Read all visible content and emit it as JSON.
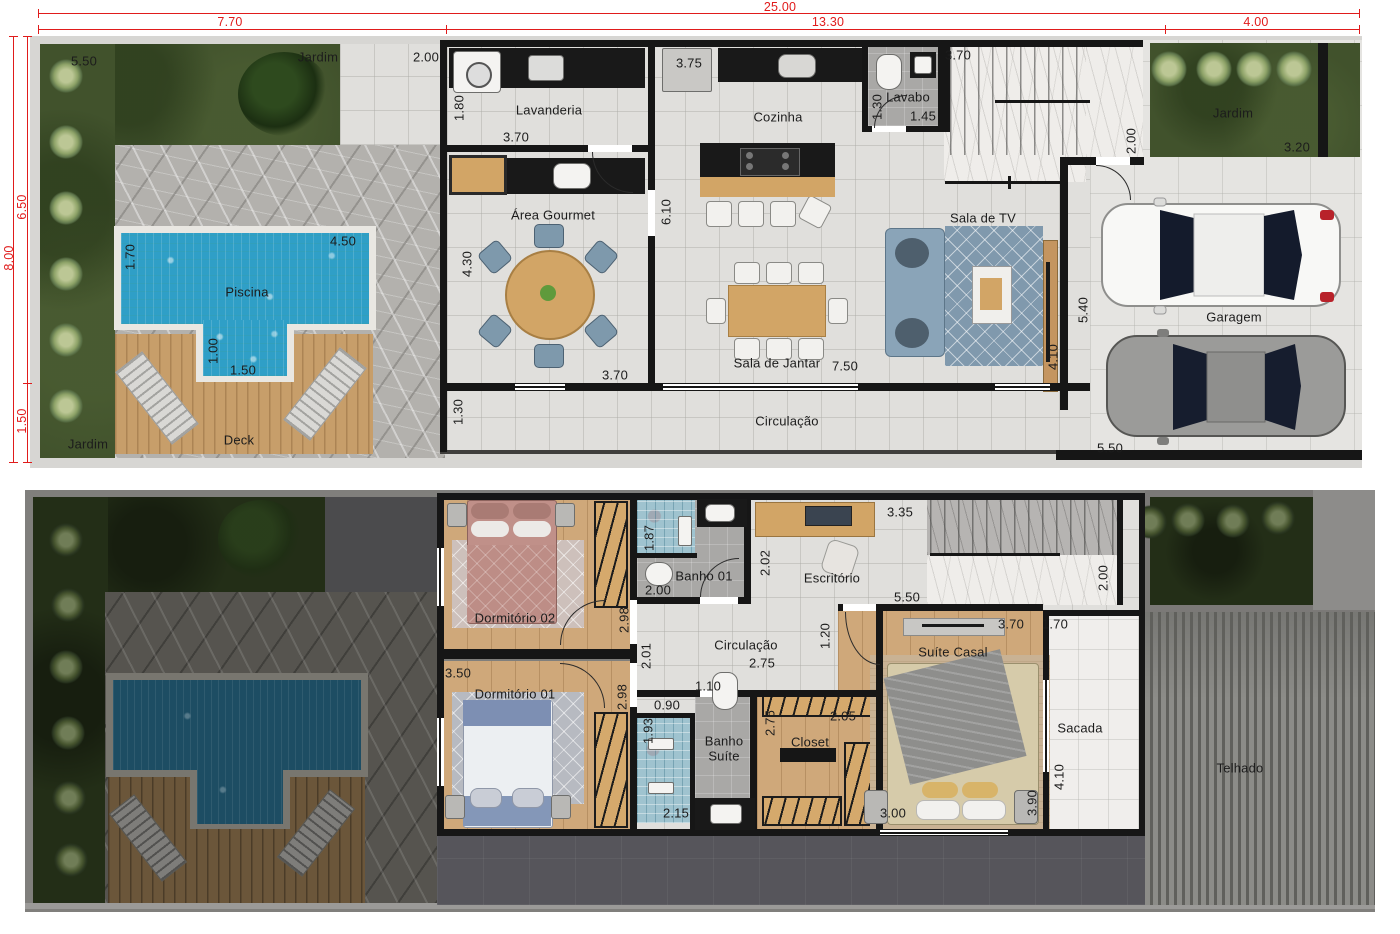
{
  "site_dimensions": {
    "total_width": "25.00",
    "width_segments": [
      "7.70",
      "13.30",
      "4.00"
    ],
    "total_depth": "8.00",
    "depth_segments": [
      "6.50",
      "1.50"
    ],
    "labels": [
      {
        "text": "25.00",
        "x": 780,
        "y": 7
      },
      {
        "text": "7.70",
        "x": 230,
        "y": 22
      },
      {
        "text": "13.30",
        "x": 828,
        "y": 22
      },
      {
        "text": "4.00",
        "x": 1256,
        "y": 22
      },
      {
        "text": "8.00",
        "x": 9,
        "y": 258,
        "v": true
      },
      {
        "text": "6.50",
        "x": 22,
        "y": 207,
        "v": true
      },
      {
        "text": "1.50",
        "x": 22,
        "y": 421,
        "v": true
      }
    ]
  },
  "colors": {
    "dimension_red": "#e01b1b",
    "wall_black": "#161616",
    "pool_blue": "#2f9fc7",
    "deck_wood": "#c79e6a",
    "garden_green": "#41522c",
    "upper_wood_floor": "#cfa87a"
  },
  "ground_floor": {
    "rooms": [
      "Jardim",
      "Piscina",
      "Deck",
      "Lavanderia",
      "Área Gourmet",
      "Cozinha",
      "Lavabo",
      "Sala de TV",
      "Sala de Jantar",
      "Circulação",
      "Garagem"
    ],
    "labels": [
      {
        "text": "5.50",
        "x": 84,
        "y": 61
      },
      {
        "text": "Jardim",
        "x": 318,
        "y": 57
      },
      {
        "text": "2.00",
        "x": 426,
        "y": 57
      },
      {
        "text": "1.80",
        "x": 459,
        "y": 108,
        "v": true
      },
      {
        "text": "Lavanderia",
        "x": 549,
        "y": 110
      },
      {
        "text": "3.70",
        "x": 516,
        "y": 137
      },
      {
        "text": "3.75",
        "x": 689,
        "y": 63
      },
      {
        "text": "Cozinha",
        "x": 778,
        "y": 117
      },
      {
        "text": "1.30",
        "x": 877,
        "y": 107,
        "v": true
      },
      {
        "text": "Lavabo",
        "x": 908,
        "y": 97
      },
      {
        "text": "1.45",
        "x": 923,
        "y": 116
      },
      {
        "text": "3.70",
        "x": 958,
        "y": 55
      },
      {
        "text": "2.00",
        "x": 1131,
        "y": 141,
        "v": true
      },
      {
        "text": "Jardim",
        "x": 1233,
        "y": 113
      },
      {
        "text": "3.20",
        "x": 1297,
        "y": 147
      },
      {
        "text": "Área Gourmet",
        "x": 553,
        "y": 215
      },
      {
        "text": "4.30",
        "x": 467,
        "y": 264,
        "v": true
      },
      {
        "text": "6.10",
        "x": 666,
        "y": 212,
        "v": true
      },
      {
        "text": "Sala de TV",
        "x": 983,
        "y": 218
      },
      {
        "text": "1.70",
        "x": 130,
        "y": 257,
        "v": true
      },
      {
        "text": "4.50",
        "x": 343,
        "y": 241
      },
      {
        "text": "Piscina",
        "x": 247,
        "y": 292
      },
      {
        "text": "1.00",
        "x": 213,
        "y": 351,
        "v": true
      },
      {
        "text": "1.50",
        "x": 243,
        "y": 370
      },
      {
        "text": "Sala de Jantar",
        "x": 777,
        "y": 363
      },
      {
        "text": "7.50",
        "x": 845,
        "y": 366
      },
      {
        "text": "5.40",
        "x": 1083,
        "y": 310,
        "v": true
      },
      {
        "text": "4.10",
        "x": 1053,
        "y": 357,
        "v": true
      },
      {
        "text": "Garagem",
        "x": 1234,
        "y": 317
      },
      {
        "text": "Deck",
        "x": 239,
        "y": 440
      },
      {
        "text": "Jardim",
        "x": 88,
        "y": 444
      },
      {
        "text": "1.30",
        "x": 458,
        "y": 412,
        "v": true
      },
      {
        "text": "Circulação",
        "x": 787,
        "y": 421
      },
      {
        "text": "3.70",
        "x": 615,
        "y": 375
      },
      {
        "text": "5.50",
        "x": 1110,
        "y": 448
      }
    ]
  },
  "upper_floor": {
    "rooms": [
      "Dormitório 02",
      "Banho 01",
      "Escritório",
      "Circulação",
      "Dormitório 01",
      "Banho Suíte",
      "Closet",
      "Suíte Casal",
      "Sacada",
      "Telhado"
    ],
    "labels": [
      {
        "text": "1.87",
        "x": 649,
        "y": 538,
        "v": true
      },
      {
        "text": "Banho 01",
        "x": 704,
        "y": 576
      },
      {
        "text": "2.00",
        "x": 658,
        "y": 590
      },
      {
        "text": "2.02",
        "x": 765,
        "y": 563,
        "v": true
      },
      {
        "text": "Escritório",
        "x": 832,
        "y": 578
      },
      {
        "text": "3.35",
        "x": 900,
        "y": 512
      },
      {
        "text": "5.50",
        "x": 907,
        "y": 597
      },
      {
        "text": "2.00",
        "x": 1103,
        "y": 578,
        "v": true
      },
      {
        "text": "Dormitório 02",
        "x": 515,
        "y": 618
      },
      {
        "text": "2.98",
        "x": 624,
        "y": 620,
        "v": true
      },
      {
        "text": "Circulação",
        "x": 746,
        "y": 645
      },
      {
        "text": "2.75",
        "x": 762,
        "y": 663
      },
      {
        "text": "2.01",
        "x": 646,
        "y": 656,
        "v": true
      },
      {
        "text": "1.20",
        "x": 825,
        "y": 636,
        "v": true
      },
      {
        "text": "3.50",
        "x": 458,
        "y": 673
      },
      {
        "text": "Dormitório 01",
        "x": 515,
        "y": 694
      },
      {
        "text": "2.98",
        "x": 622,
        "y": 697,
        "v": true
      },
      {
        "text": "0.90",
        "x": 667,
        "y": 705
      },
      {
        "text": "1.10",
        "x": 708,
        "y": 686
      },
      {
        "text": "Banho Suíte",
        "x": 724,
        "y": 749,
        "w": 50
      },
      {
        "text": "1.93",
        "x": 648,
        "y": 731,
        "v": true
      },
      {
        "text": "2.15",
        "x": 676,
        "y": 813
      },
      {
        "text": "2.75",
        "x": 770,
        "y": 723,
        "v": true
      },
      {
        "text": "2.05",
        "x": 843,
        "y": 716
      },
      {
        "text": "Closet",
        "x": 810,
        "y": 742
      },
      {
        "text": "Suíte Casal",
        "x": 953,
        "y": 652
      },
      {
        "text": "3.70",
        "x": 1011,
        "y": 624
      },
      {
        "text": "1.70",
        "x": 1055,
        "y": 624
      },
      {
        "text": "Sacada",
        "x": 1080,
        "y": 728
      },
      {
        "text": "4.10",
        "x": 1059,
        "y": 777,
        "v": true
      },
      {
        "text": "3.00",
        "x": 893,
        "y": 813
      },
      {
        "text": "3.90",
        "x": 1032,
        "y": 803,
        "v": true
      },
      {
        "text": "Telhado",
        "x": 1240,
        "y": 768
      }
    ]
  }
}
